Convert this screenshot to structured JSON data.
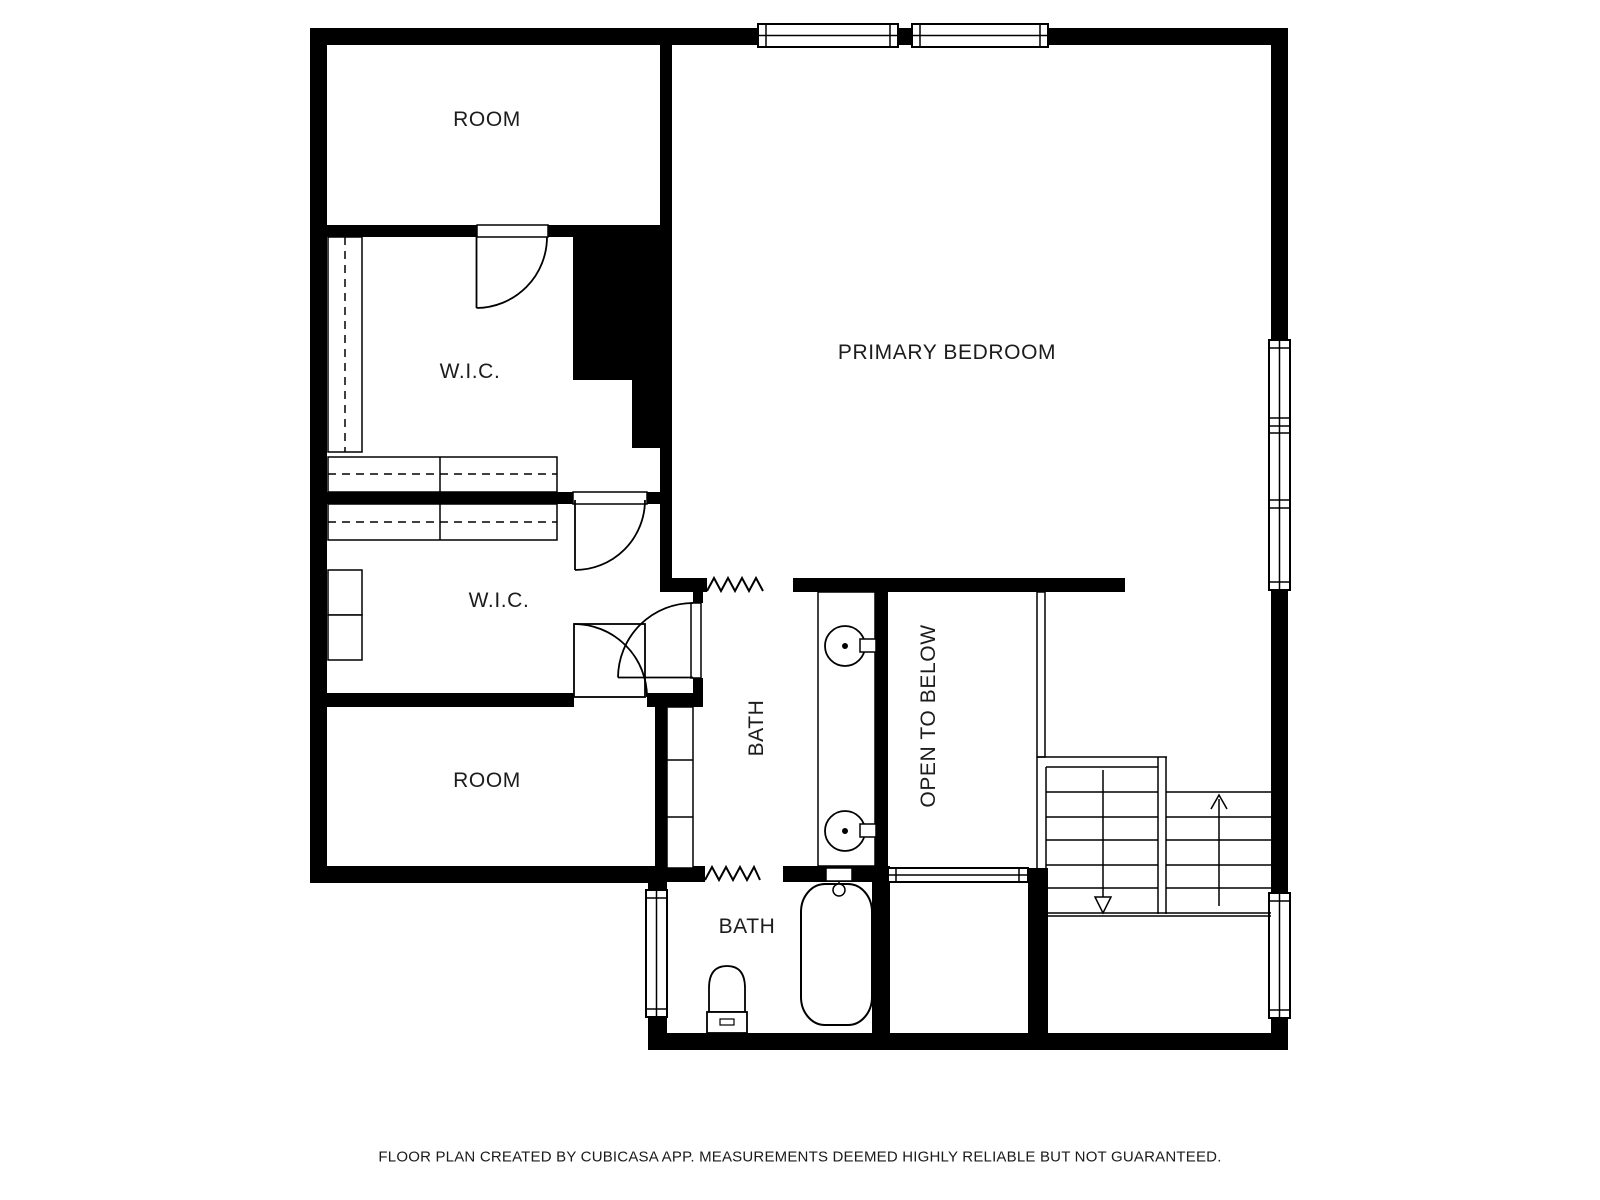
{
  "page": {
    "background": "#ffffff",
    "wall_color": "#000000",
    "line_color": "#000000",
    "label_color": "#1c1c1c"
  },
  "rooms": {
    "room_top": "ROOM",
    "wic_upper": "W.I.C.",
    "wic_lower": "W.I.C.",
    "primary_bedroom": "PRIMARY BEDROOM",
    "bath_upper": "BATH",
    "open_to_below": "OPEN TO BELOW",
    "room_bottom": "ROOM",
    "bath_lower": "BATH"
  },
  "fixtures": {
    "icons": [
      "sink-icon",
      "sink-icon",
      "bathtub-icon",
      "toilet-icon",
      "vanity-counter",
      "closet-shelf",
      "stairs",
      "stairs-up-arrow-icon",
      "stairs-down-arrow-icon",
      "door-swing-icon",
      "window-icon",
      "opening-zigzag-icon",
      "railing-icon"
    ]
  },
  "footer": {
    "disclaimer": "FLOOR PLAN CREATED BY CUBICASA APP. MEASUREMENTS DEEMED HIGHLY RELIABLE BUT NOT GUARANTEED."
  }
}
